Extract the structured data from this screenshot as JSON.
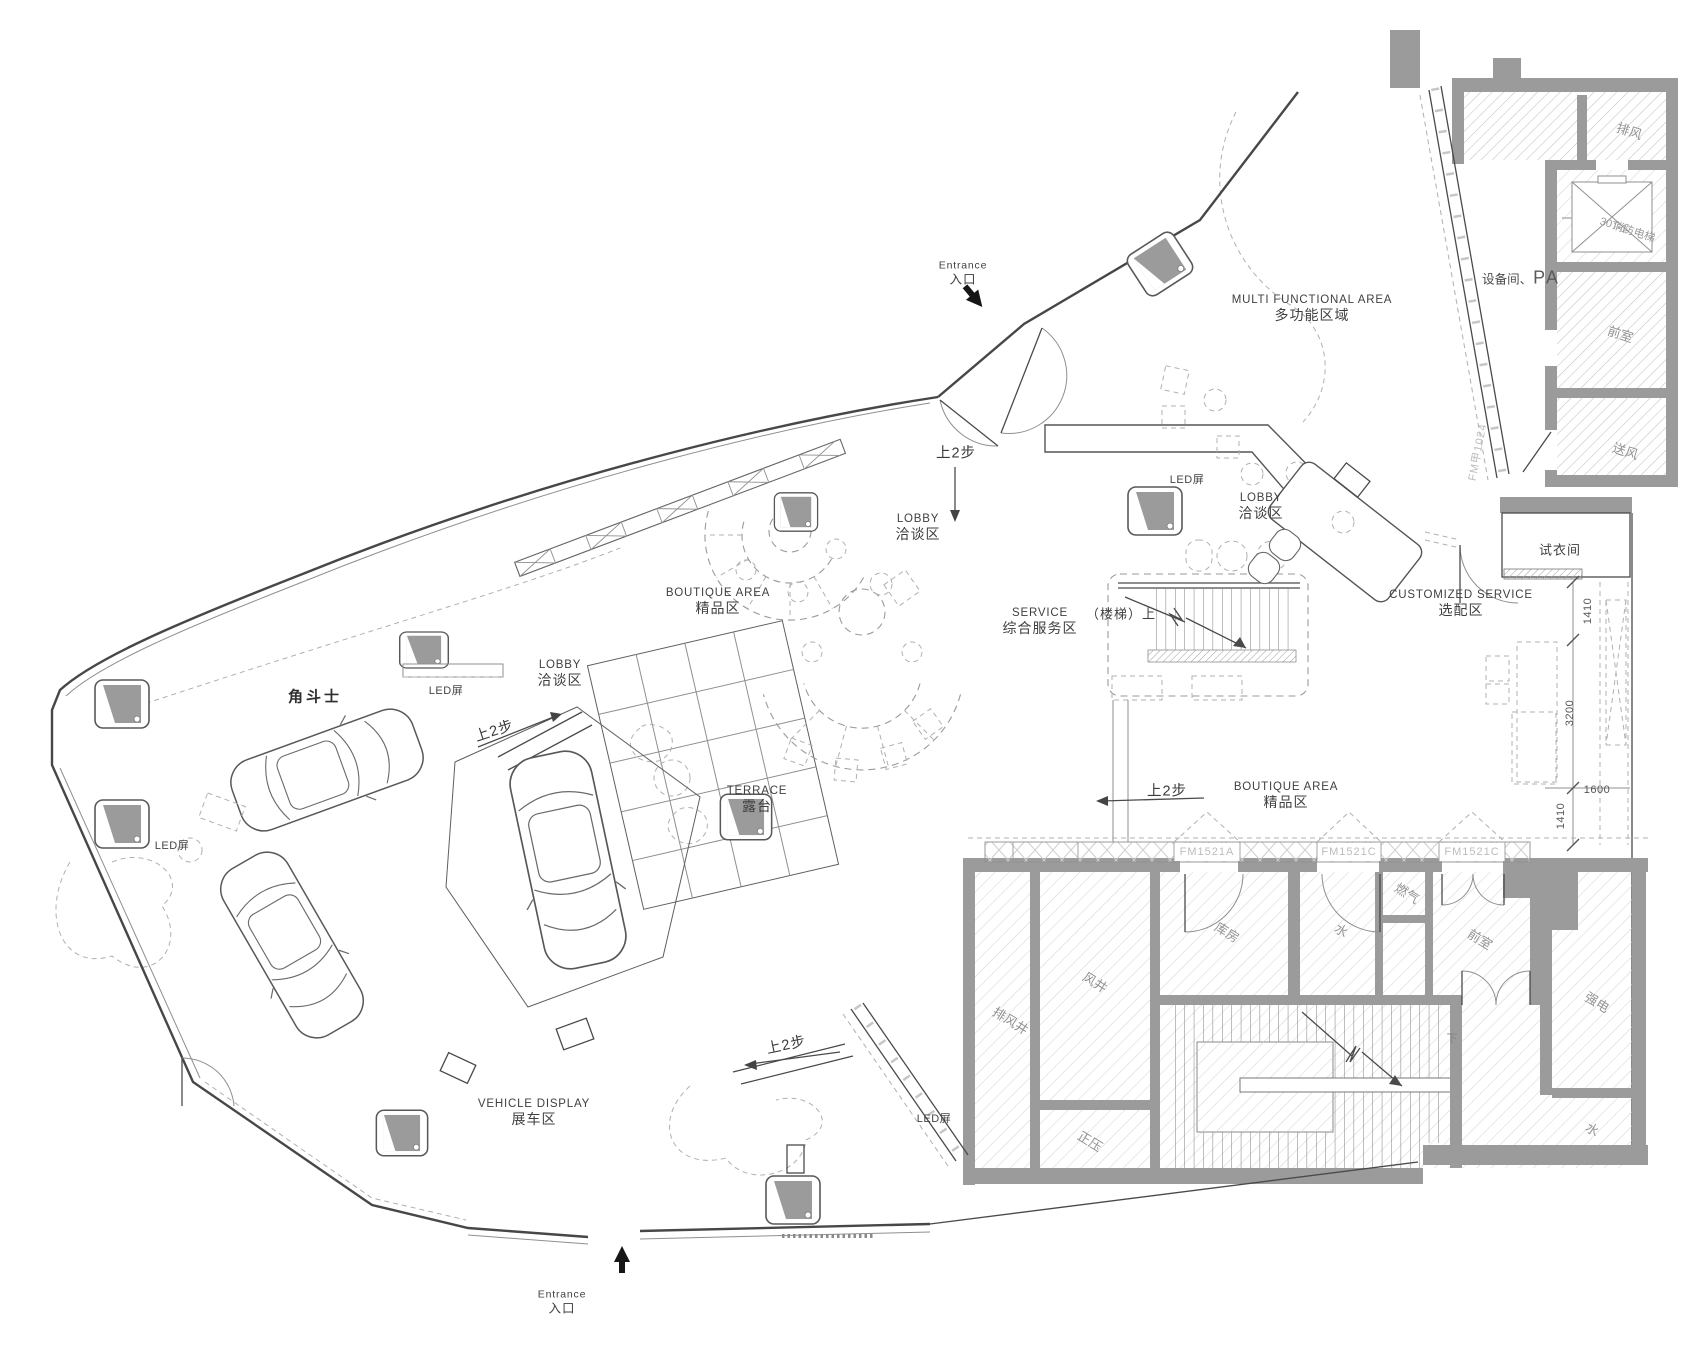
{
  "areas": {
    "entrance": {
      "en": "Entrance",
      "zh": "入口"
    },
    "multi_functional": {
      "en": "MULTI FUNCTIONAL AREA",
      "zh": "多功能区域"
    },
    "boutique": {
      "en": "BOUTIQUE AREA",
      "zh": "精品区"
    },
    "lobby": {
      "en": "LOBBY",
      "zh": "洽谈区"
    },
    "service": {
      "en": "SERVICE",
      "zh": "综合服务区"
    },
    "customized_service": {
      "en": "CUSTOMIZED SERVICE",
      "zh": "选配区"
    },
    "terrace": {
      "en": "TERRACE",
      "zh": "露台"
    },
    "vehicle_display": {
      "en": "VEHICLE DISPLAY",
      "zh": "展车区"
    },
    "fitting_room": {
      "zh": "试衣间"
    },
    "equipment_room": {
      "zh": "设备间、",
      "en": "PA"
    },
    "car_model": {
      "zh": "角斗士"
    }
  },
  "rooms": {
    "exhaust_air": "排风",
    "fire_elevator_no": "30T-1",
    "fire_elevator": "消防电梯",
    "front_room_ne": "前室",
    "supply_air": "送风",
    "exhaust_shaft": "排风井",
    "air_shaft": "风井",
    "storage": "库房",
    "water_a": "水",
    "gas": "燃气",
    "front_room_se": "前室",
    "strong_electric": "强电",
    "positive_pressure": "正压",
    "water_b": "水"
  },
  "annotations": {
    "steps_up": "上2步",
    "stairs_up": "（楼梯）上",
    "down": "下",
    "led_screen": "LED屏",
    "door_code_a": "FM1521A",
    "door_code_c": "FM1521C",
    "door_code_main": "FM甲1024"
  },
  "dimensions": {
    "d1": "1410",
    "d2": "3200",
    "d3": "1600",
    "d4": "1410"
  },
  "colors": {
    "wall": "#9b9b9b",
    "line": "#4a4a4a",
    "hatch": "#c2c2c2",
    "room_label": "#939393"
  }
}
